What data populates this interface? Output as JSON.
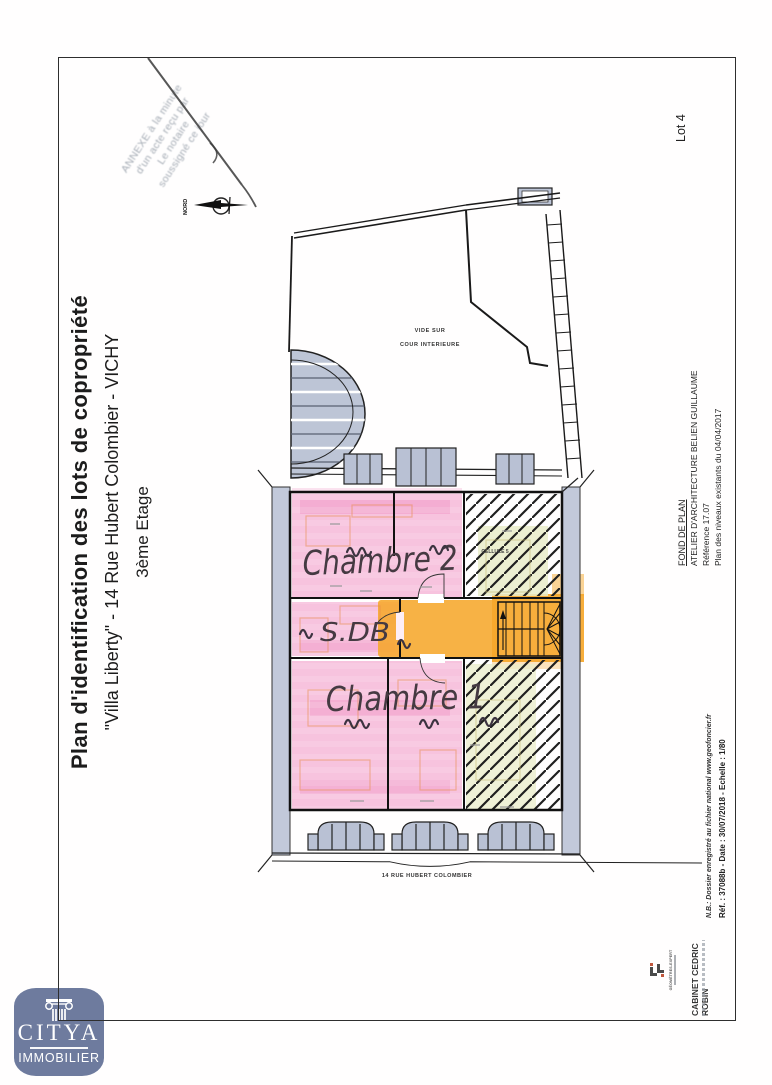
{
  "stamp": {
    "line1": "ANNEXE à la minute",
    "line2": "d'un acte reçu par",
    "line3": "Le notaire",
    "line4": "soussigné ce jour"
  },
  "north_label": "NORD",
  "lot_label": "Lot 4",
  "title_block": {
    "title": "Plan d'identification des lots de copropriété",
    "subtitle": "\"Villa Liberty\" - 14 Rue Hubert Colombier - VICHY",
    "floor": "3ème Etage"
  },
  "architect_block": {
    "heading": "FOND DE PLAN",
    "studio": "ATELIER D'ARCHITECTURE BELIEN GUILLAUME",
    "reference": "Référence 17.07",
    "plan_note": "Plan des niveaux existants du 04/04/2017"
  },
  "surveyor_block": {
    "nb_note": "N.B.: Dossier enregistré au fichier national www.geofoncier.fr",
    "ref_line": "Réf. : 37088b - Date : 30/07/2018 - Echelle : 1/80",
    "cabinet": "CABINET CEDRIC ROBIN",
    "logo_caption": "GÉOMÈTRES-EXPERT"
  },
  "plan": {
    "court_line1": "VIDE SUR",
    "court_line2": "COUR INTERIEURE",
    "chambre2": "Chambre 2",
    "sdb": "S.DB",
    "chambre1": "Chambre 1",
    "cellule5": "CELLULE 5",
    "street": "14 RUE HUBERT COLOMBIER"
  },
  "citya": {
    "name": "CITYA",
    "tagline": "IMMOBILIER"
  },
  "colors": {
    "highlight_pink": "#F29BC6",
    "highlight_orange": "#F6A72B",
    "hatch_tint": "#E9ECC9",
    "wall_gray": "#BCC4D6",
    "citya_blue": "#6E7B9E"
  }
}
